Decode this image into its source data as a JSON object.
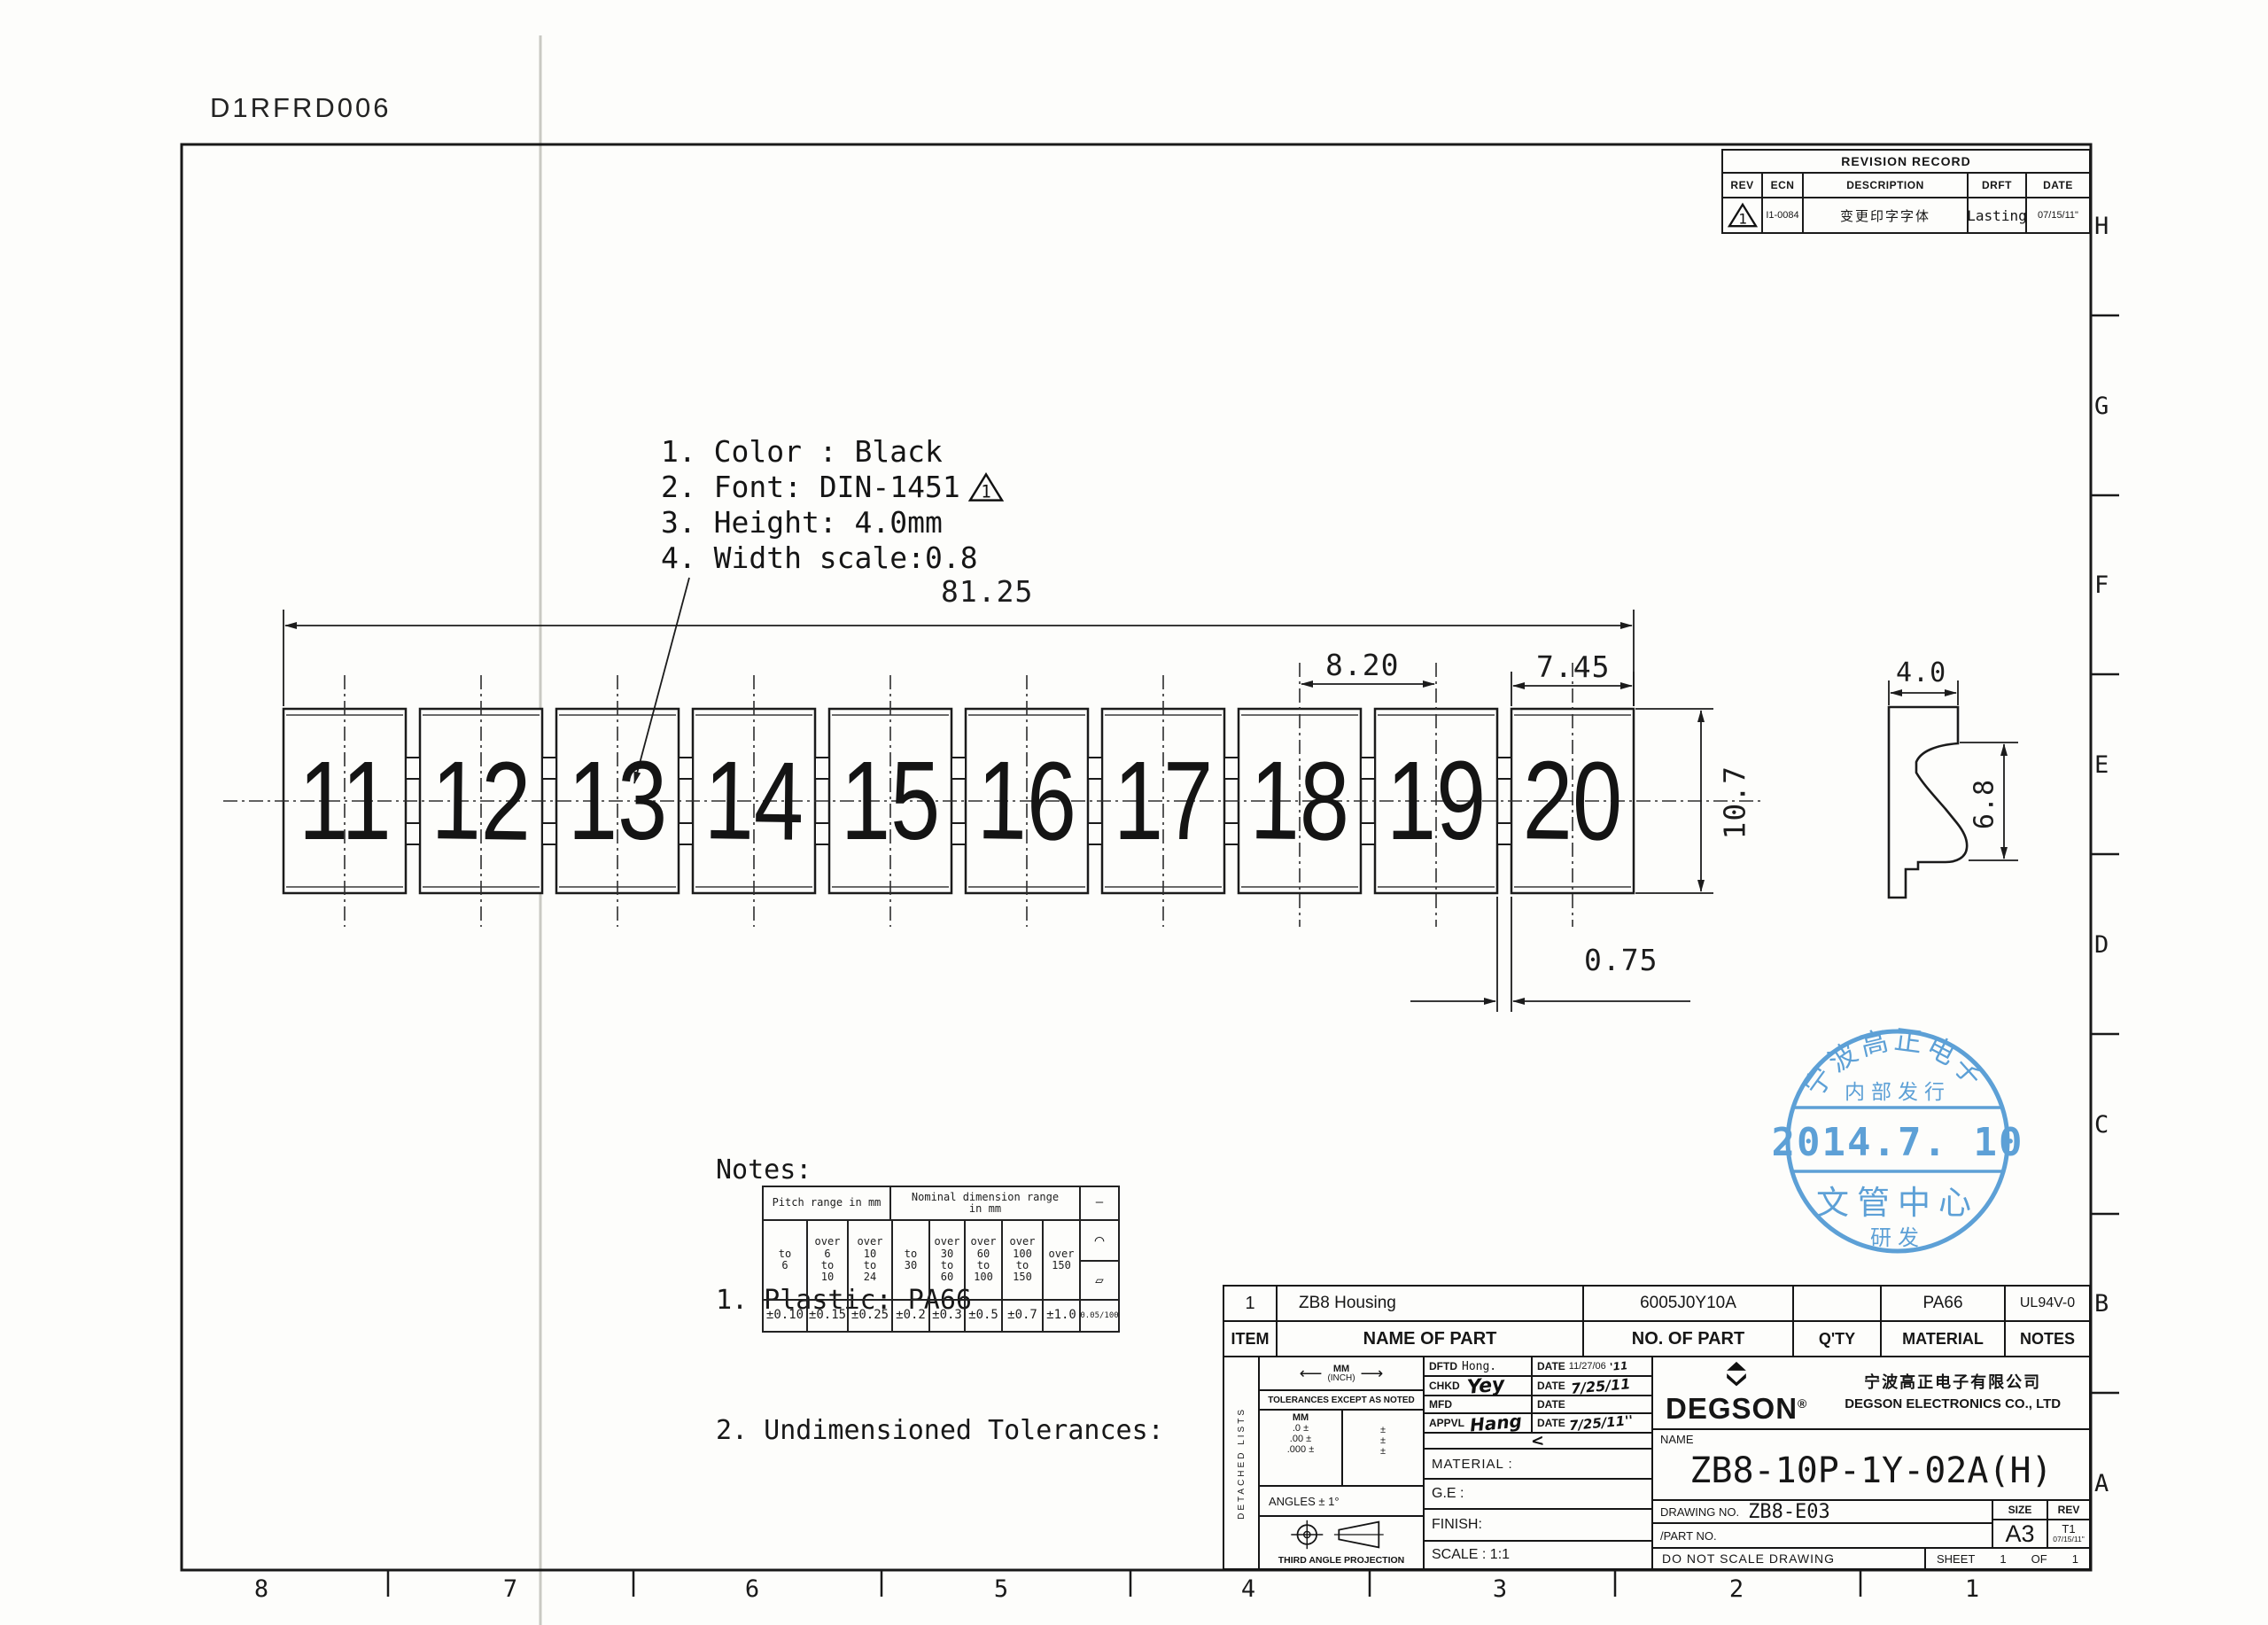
{
  "doc_code": "D1RFRD006",
  "revision_table": {
    "title": "REVISION RECORD",
    "headers": [
      "REV",
      "ECN",
      "DESCRIPTION",
      "DRFT",
      "DATE"
    ],
    "row": {
      "rev_flag": "1",
      "ecn": "I1-0084",
      "description": "变更印字字体",
      "drft": "Lasting",
      "date": "07/15/11\""
    }
  },
  "print_notes": {
    "line1": "1. Color : Black",
    "line2": "2. Font: DIN-1451",
    "line2_flag": "1",
    "line3": "3. Height: 4.0mm",
    "line4": "4. Width scale:0.8"
  },
  "markers": [
    "11",
    "12",
    "13",
    "14",
    "15",
    "16",
    "17",
    "18",
    "19",
    "20"
  ],
  "dimensions": {
    "overall": "81.25",
    "pitch": "8.20",
    "marker_width": "7.45",
    "gap": "0.75",
    "strip_height": "10.7",
    "profile_width": "4.0",
    "profile_height": "6.8"
  },
  "notes": {
    "title": "Notes:",
    "item1": "1. Plastic: PA66",
    "item2": "2. Undimensioned Tolerances:"
  },
  "tolerance_table": {
    "pitch_header": "Pitch range in mm",
    "nominal_header": "Nominal dimension range\nin mm",
    "straight_sym": "—",
    "arc_sym": "⌒",
    "para_sym": "▱",
    "cols": [
      "to\n6",
      "over\n6\nto\n10",
      "over\n10\nto\n24",
      "to\n30",
      "over\n30\nto\n60",
      "over\n60\nto\n100",
      "over\n100\nto\n150",
      "over\n150"
    ],
    "values": [
      "±0.10",
      "±0.15",
      "±0.25",
      "±0.2",
      "±0.3",
      "±0.5",
      "±0.7",
      "±1.0",
      "0.05/100"
    ]
  },
  "parts_list": {
    "row": {
      "item": "1",
      "name": "ZB8  Housing",
      "part_no": "6005J0Y10A",
      "qty": "",
      "material": "PA66",
      "notes": "UL94V-0"
    },
    "headers": {
      "item": "ITEM",
      "name": "NAME OF PART",
      "part_no": "NO. OF PART",
      "qty": "Q'TY",
      "material": "MATERIAL",
      "notes": "NOTES"
    }
  },
  "title_block": {
    "detached": "DETACHED LISTS",
    "arrow_left": "⟵",
    "arrow_right": "⟶",
    "units_mm": "MM",
    "units_inch": "(INCH)",
    "tol_note": "TOLERANCES EXCEPT AS NOTED",
    "mm_head": "MM",
    "tol1": ".0 ±",
    "tol2": ".00 ±",
    "tol3": ".000 ±",
    "pm": "±",
    "angles": "ANGLES ± 1°",
    "projection": "THIRD ANGLE PROJECTION",
    "dftd_label": "DFTD",
    "dftd_value": "Hong.",
    "chkd_label": "CHKD",
    "chkd_sig": "Yey",
    "mfd_label": "MFD",
    "appvl_label": "APPVL",
    "appvl_sig": "Hang",
    "date_label": "DATE",
    "dftd_date": "11/27/06",
    "dftd_date_hand": "'11",
    "chkd_date": "7/25/11",
    "appvl_date": "7/25/11''",
    "check_mark": "<",
    "material_label": "MATERIAL :",
    "ge_label": "G.E :",
    "finish_label": "FINISH:",
    "scale_label": "SCALE : 1:1",
    "logo_text": "DEGSON",
    "logo_reg": "®",
    "company_cn": "宁波高正电子有限公司",
    "company_en": "DEGSON ELECTRONICS CO., LTD",
    "name_label": "NAME",
    "part_name": "ZB8-10P-1Y-02A(H)",
    "drawing_no_label": "DRAWING NO.",
    "drawing_no": "ZB8-E03",
    "part_no_label": "/PART  NO.",
    "size_label": "SIZE",
    "size": "A3",
    "rev_label": "REV",
    "rev": "T1",
    "rev_date": "07/15/11\"",
    "do_not_scale": "DO NOT SCALE DRAWING",
    "sheet_label": "SHEET",
    "sheet_no": "1",
    "of_label": "OF",
    "of_no": "1"
  },
  "stamp": {
    "arc_text": "宁波高正电子",
    "inner_top": "内部发行",
    "date": "2014.7. 10",
    "band": "文管中心",
    "bottom": "研发",
    "color": "#3a8cce"
  },
  "border": {
    "right_letters": [
      "H",
      "G",
      "F",
      "E",
      "D",
      "C",
      "B",
      "A"
    ],
    "bottom_numbers": [
      "8",
      "7",
      "6",
      "5",
      "4",
      "3",
      "2",
      "1"
    ]
  }
}
